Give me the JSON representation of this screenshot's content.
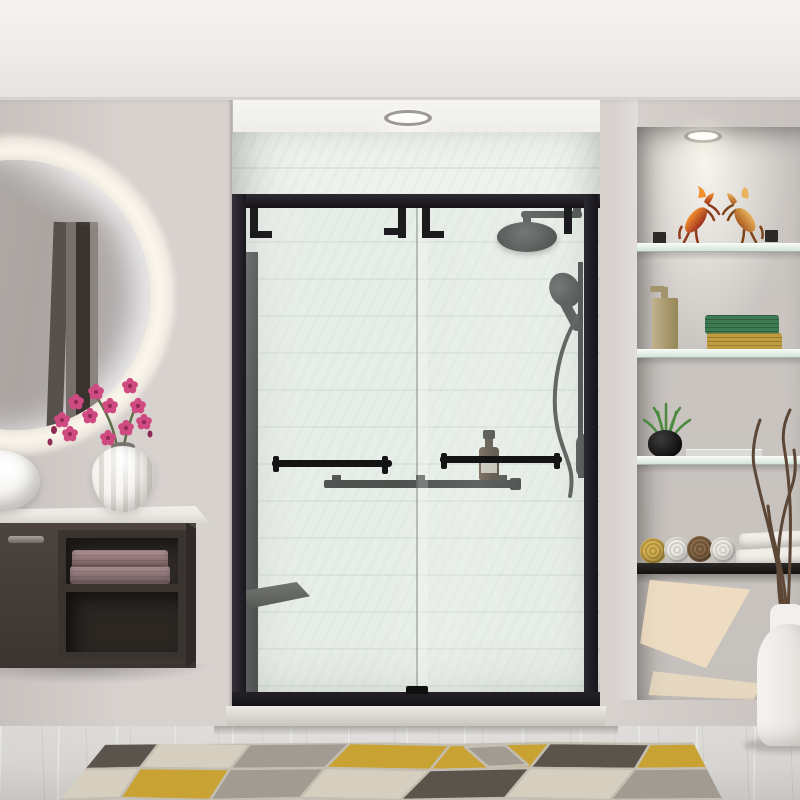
{
  "scene": {
    "inventory": [
      "backlit-round-mirror",
      "vessel-sink",
      "floating-vanity",
      "mauve-towels",
      "fluted-white-vase",
      "pink-orchid",
      "alcove-shower",
      "black-shower-frame",
      "sliding-glass-doors",
      "rain-shower-head",
      "handheld-shower",
      "slide-bar",
      "valve-trim",
      "towel-bar-handles",
      "black-glass-shelf",
      "amber-bottle",
      "corner-seat",
      "recessed-ceiling-light",
      "niche-recessed-light",
      "wall-niche",
      "glass-shelves",
      "horse-figurines",
      "brass-soap-dispenser",
      "woven-towel-stack",
      "grass-plant-black-pot",
      "glass-tray",
      "rolled-towels",
      "folded-white-towels",
      "sunlight-patches",
      "white-floor-vase-with-twigs",
      "geometric-rug",
      "marble-floor"
    ],
    "rolled_towel_colors": [
      "yellow",
      "white",
      "brown",
      "white"
    ],
    "figurine_pose": "two rearing horses facing each other"
  },
  "colors": {
    "wall": "#d8d2cf",
    "wallShade": "#c8c2bf",
    "alcoveCeiling": "#f6f5f2",
    "tile": "#eef1ec",
    "tileLine": "#dde4dd",
    "fixture": "#1c1c1e",
    "glassTint": "rgba(216,228,220,0.30)",
    "counter": "#e9e7e1",
    "cabinet": "#4c443f",
    "cabinetSide": "#2f2a27",
    "cavity": "#2e2925",
    "towelA": "#8f7678",
    "towelB": "#97797b",
    "sink": "#f6f4f0",
    "vase": "#f6f4f1",
    "orchid": "#cf4a80",
    "orchidDeep": "#8e2b55",
    "stem": "#5f6e49",
    "mirrorFace": "#aba5a2",
    "mirrorBar1": "#57504b",
    "mirrorBar2": "#776f69",
    "mirrorBar3": "#3a342f",
    "labelCream": "#d9d3c9",
    "curbTop": "#dcd9d3",
    "curbBottom": "#c6c3bd",
    "floor": "#d7d5d1",
    "rugCream": "#d6cfc0",
    "rugYellow": "#c8a233",
    "rugCharcoal": "#5b544d",
    "rugGray": "#a29b92",
    "rugBorder": "#c4beb2",
    "nicheWall": "#ccc7c3",
    "sun": "#f4e1c2",
    "glassShelf": "#cfe0d4",
    "mountDark": "#2b2a28",
    "brassLight": "#c0b28c",
    "brassDark": "#968757",
    "weaveGreen": "#3e7a52",
    "weaveYellow": "#c09d40",
    "rollYellow": "#d3b253",
    "rollYellowRing": "#b3923e",
    "rollWhite": "#edebe6",
    "rollWhiteRing": "#d2cfc8",
    "rollBrown": "#8a6b4a",
    "rollBrownRing": "#6f5438",
    "foldedWhite": "#f1efe9",
    "plantGreen": "#4c8a3f",
    "twig": "#5c4636",
    "figBodyA": "#c24a2a",
    "figBodyB": "#c77e36",
    "figMane": "#f3902e"
  }
}
